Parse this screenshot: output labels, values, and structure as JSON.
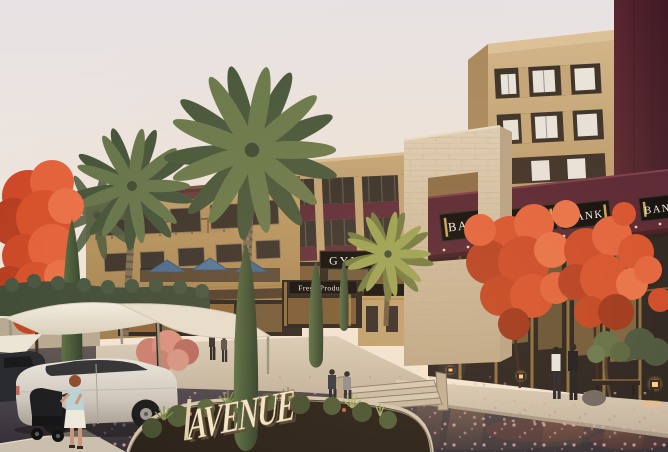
{
  "scene": {
    "signs": {
      "bank_signs": [
        "BANK",
        "BANK",
        "BANK",
        "BANK"
      ],
      "gym": "GYM",
      "fresh_produce": "Fresh Produce",
      "avenue": "AVENUE"
    },
    "palette": {
      "sky": "#e8e2e0",
      "maroon_fascia": "#552231",
      "beige_building": "#c7a97c",
      "stone_portal": "#d7c7af",
      "sandstone": "#b3905e",
      "flame_red": "#d5502a",
      "palm_green": "#68784a",
      "cypress_green": "#3f5534",
      "street_asphalt": "#3d3840",
      "canopy_white": "#efe9dc",
      "sign_panel_black": "#0a0908",
      "sign_text_white": "#f5f2ea",
      "gold_trim": "#c9a152",
      "avenue_letters": "#f2e8cc"
    }
  }
}
